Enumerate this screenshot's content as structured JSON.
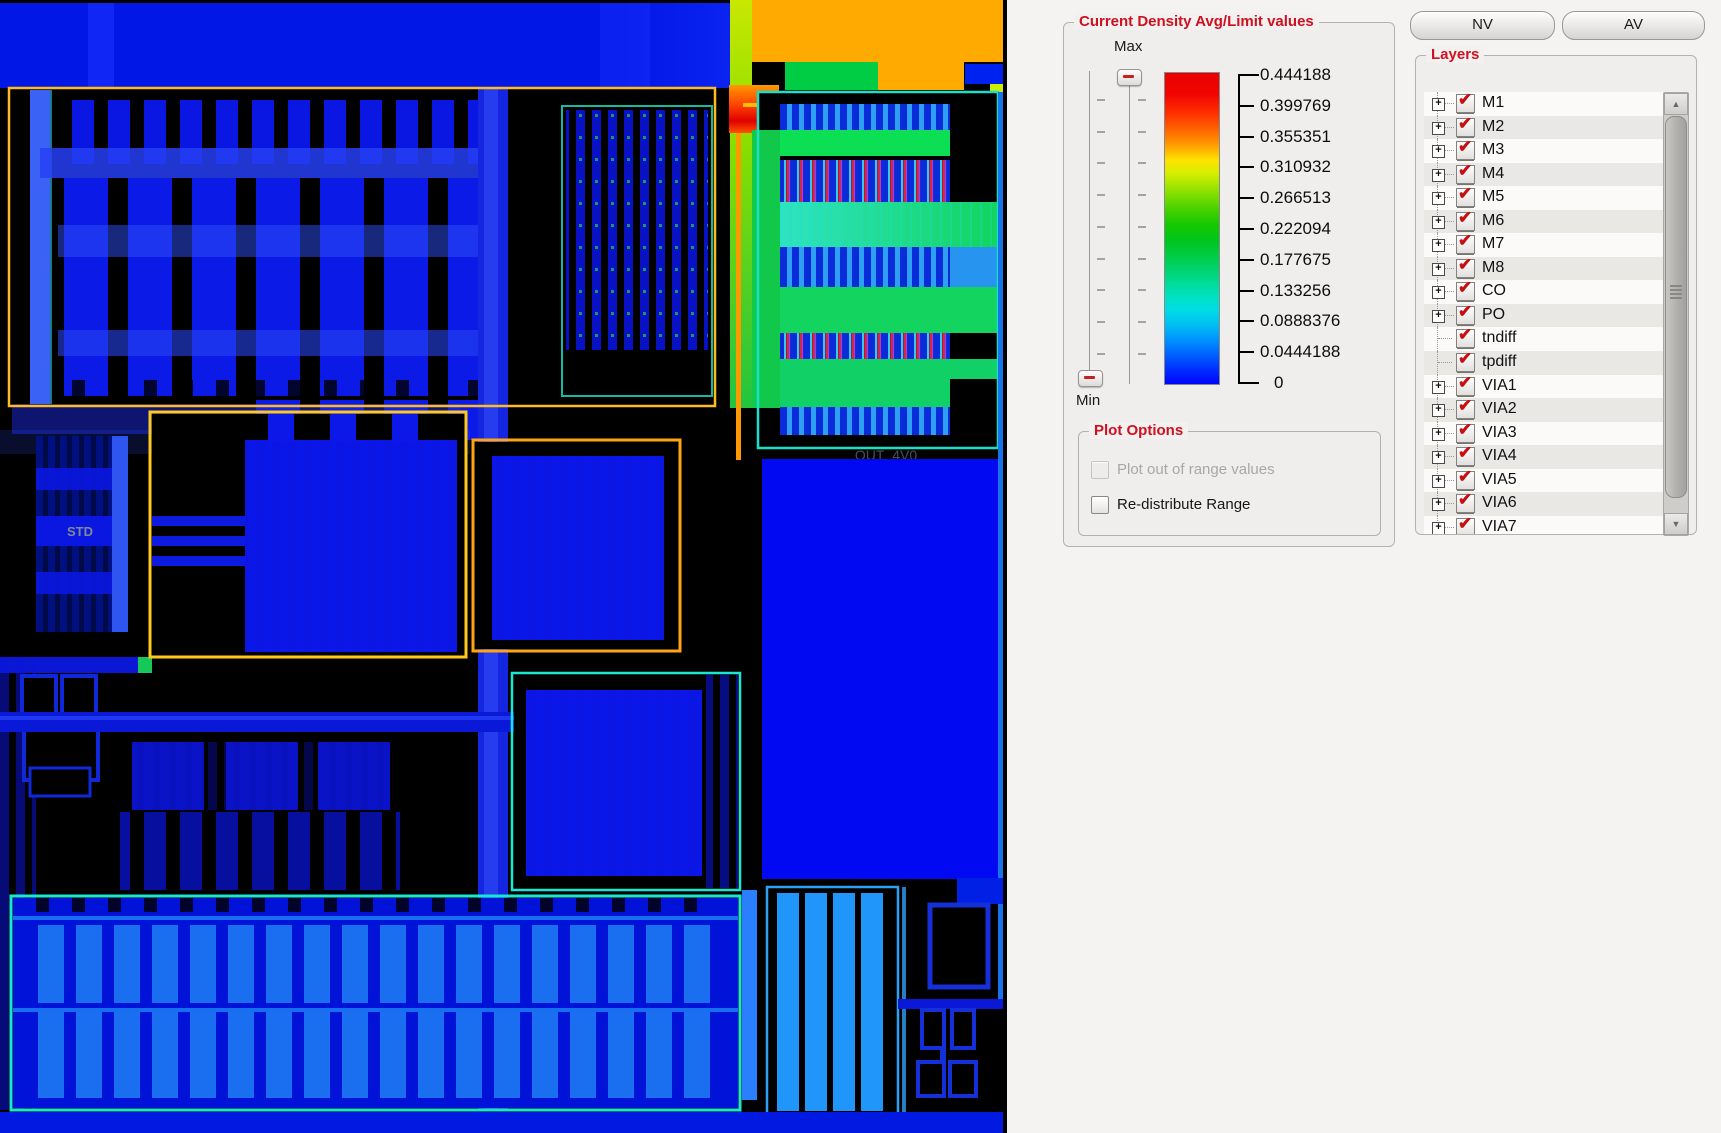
{
  "icons": {
    "check": "✔",
    "plus": "+",
    "arrow_up": "▲",
    "arrow_down": "▼"
  },
  "colors": {
    "accent_red": "#cf1020",
    "heat_max": "#e80000",
    "heat_min": "#0006ff",
    "outline_yellow": "#ffbb22",
    "outline_orange": "#ffa514",
    "outline_cyan": "#19e8d0"
  },
  "layout": {
    "labels": {
      "out_4v0": "OUT_4V0",
      "std": "STD"
    }
  },
  "density_panel": {
    "title": "Current Density Avg/Limit values",
    "max_label": "Max",
    "min_label": "Min",
    "scale_values": [
      "0.444188",
      "0.399769",
      "0.355351",
      "0.310932",
      "0.266513",
      "0.222094",
      "0.177675",
      "0.133256",
      "0.0888376",
      "0.0444188",
      "0"
    ],
    "plot_options": {
      "title": "Plot Options",
      "options": [
        {
          "label": "Plot out of range values",
          "enabled": false,
          "checked": false
        },
        {
          "label": "Re-distribute Range",
          "enabled": true,
          "checked": false
        }
      ]
    }
  },
  "toolbar": {
    "nv_label": "NV",
    "av_label": "AV"
  },
  "layers_panel": {
    "title": "Layers",
    "layers": [
      {
        "name": "M1",
        "checked": true,
        "expandable": true
      },
      {
        "name": "M2",
        "checked": true,
        "expandable": true
      },
      {
        "name": "M3",
        "checked": true,
        "expandable": true
      },
      {
        "name": "M4",
        "checked": true,
        "expandable": true
      },
      {
        "name": "M5",
        "checked": true,
        "expandable": true
      },
      {
        "name": "M6",
        "checked": true,
        "expandable": true
      },
      {
        "name": "M7",
        "checked": true,
        "expandable": true
      },
      {
        "name": "M8",
        "checked": true,
        "expandable": true
      },
      {
        "name": "CO",
        "checked": true,
        "expandable": true
      },
      {
        "name": "PO",
        "checked": true,
        "expandable": true
      },
      {
        "name": "tndiff",
        "checked": true,
        "expandable": false
      },
      {
        "name": "tpdiff",
        "checked": true,
        "expandable": false
      },
      {
        "name": "VIA1",
        "checked": true,
        "expandable": true
      },
      {
        "name": "VIA2",
        "checked": true,
        "expandable": true
      },
      {
        "name": "VIA3",
        "checked": true,
        "expandable": true
      },
      {
        "name": "VIA4",
        "checked": true,
        "expandable": true
      },
      {
        "name": "VIA5",
        "checked": true,
        "expandable": true
      },
      {
        "name": "VIA6",
        "checked": true,
        "expandable": true
      },
      {
        "name": "VIA7",
        "checked": true,
        "expandable": true
      }
    ]
  }
}
